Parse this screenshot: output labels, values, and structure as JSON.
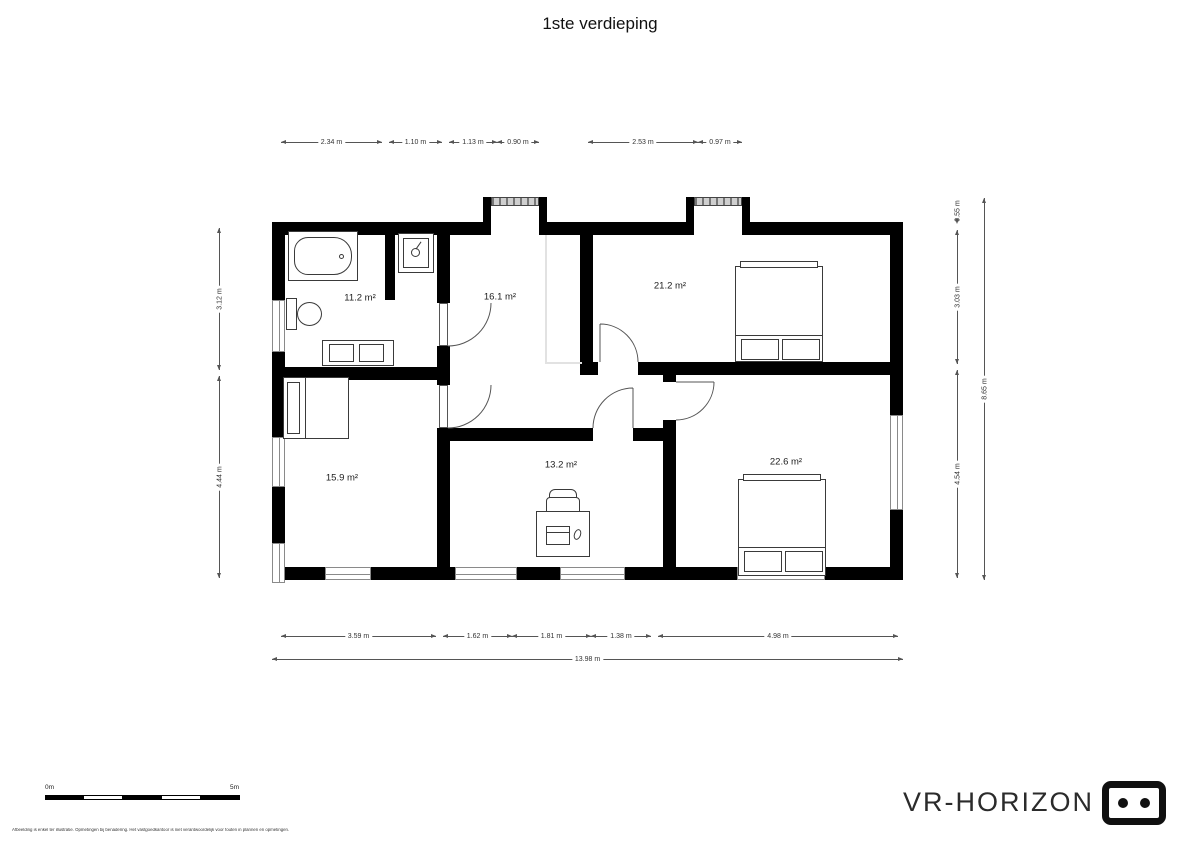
{
  "title": "1ste verdieping",
  "rooms": {
    "bathroom": "11.2 m²",
    "hall": "16.1 m²",
    "bedroom_top_right": "21.2 m²",
    "bedroom_bottom_left": "15.9 m²",
    "office": "13.2 m²",
    "bedroom_bottom_right": "22.6 m²"
  },
  "dims": {
    "top": [
      "2.34 m",
      "1.10 m",
      "1.13 m",
      "0.90 m",
      "2.53 m",
      "0.97 m"
    ],
    "bottom": [
      "3.59 m",
      "1.62 m",
      "1.81 m",
      "1.38 m",
      "4.98 m"
    ],
    "bottom_total": "13.98 m",
    "left": [
      "3.12 m",
      "4.44 m"
    ],
    "right": [
      "0.55 m",
      "3.03 m",
      "4.54 m"
    ],
    "right_total": "8.65 m"
  },
  "scale_bar": {
    "start_label": "0m",
    "end_label": "5m"
  },
  "branding": {
    "name": "VR-HORIZON"
  },
  "footer_disclaimer": "Afbeelding is enkel ter illustratie. Opmetingen bij benadering. Het vastgoedkantoor is niet verantwoordelijk voor fouten in plannen en opmetingen."
}
